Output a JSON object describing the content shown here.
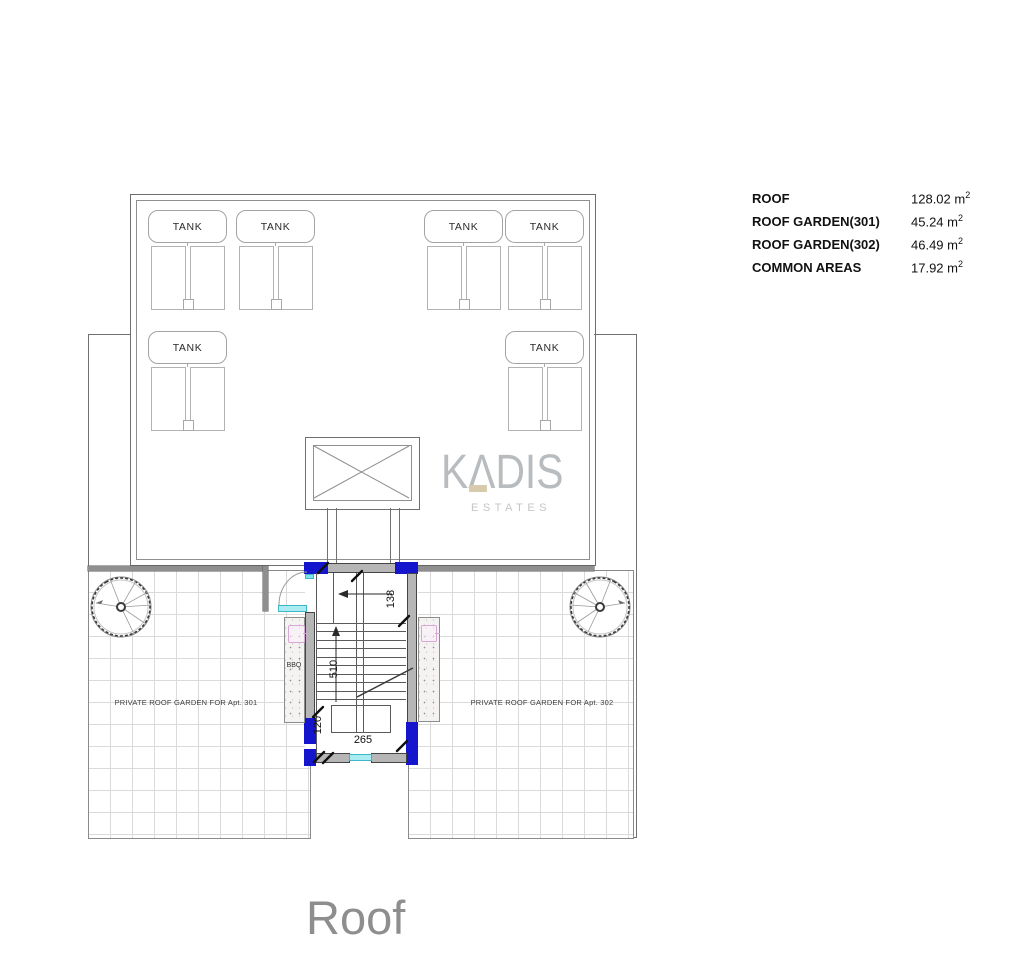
{
  "title": "Roof",
  "legend": {
    "rows": [
      {
        "label": "ROOF",
        "value": "128.02 m",
        "sup": "2"
      },
      {
        "label": "ROOF GARDEN(301)",
        "value": "45.24 m",
        "sup": "2"
      },
      {
        "label": "ROOF GARDEN(302)",
        "value": "46.49 m",
        "sup": "2"
      },
      {
        "label": "COMMON AREAS",
        "value": "17.92 m",
        "sup": "2"
      }
    ]
  },
  "plan": {
    "tank_label": "TANK",
    "garden_301": "PRIVATE ROOF GARDEN FOR Apt. 301",
    "garden_302": "PRIVATE ROOF GARDEN FOR Apt. 302",
    "bbq_label": "BBQ",
    "dims": {
      "run": "510",
      "top": "138",
      "width": "265",
      "bottom": "120"
    }
  },
  "logo": {
    "k": "K",
    "a": "Λ",
    "dis": "DIS",
    "estates": "ESTATES"
  },
  "colors": {
    "wall_blue": "#1515cd",
    "door_cyan": "#a9ecf2",
    "logo_gray": "#b9bcbe",
    "logo_accent": "#d8cbac",
    "title_gray": "#8e8e8e"
  }
}
